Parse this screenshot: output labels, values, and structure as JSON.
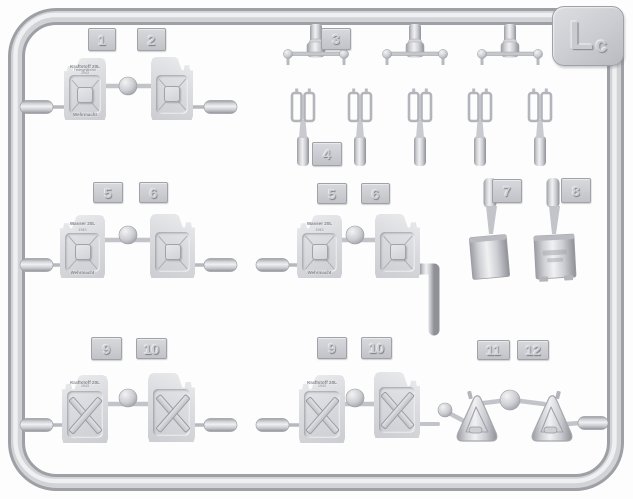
{
  "sprue": {
    "corner_code": {
      "main": "L",
      "sub": "c"
    },
    "tags": {
      "t1": "1",
      "t2": "2",
      "t3": "3",
      "t4": "4",
      "t5l": "5",
      "t6l": "6",
      "t5c": "5",
      "t6c": "6",
      "t7": "7",
      "t8": "8",
      "t9l": "9",
      "t10l": "10",
      "t9c": "9",
      "t10c": "10",
      "t11": "11",
      "t12": "12"
    },
    "markings": {
      "fuel": {
        "l1": "Kraftstoff 20L",
        "l2": "Feuergefährlich",
        "l3": "1943",
        "bottom": "Wehrmacht"
      },
      "water": {
        "l1": "Wasser 20L",
        "l3": "1943",
        "bottom": "Wehrmacht"
      },
      "fuel_x": {
        "l1": "Kraftstoff 20L",
        "l3": "1943"
      }
    }
  }
}
